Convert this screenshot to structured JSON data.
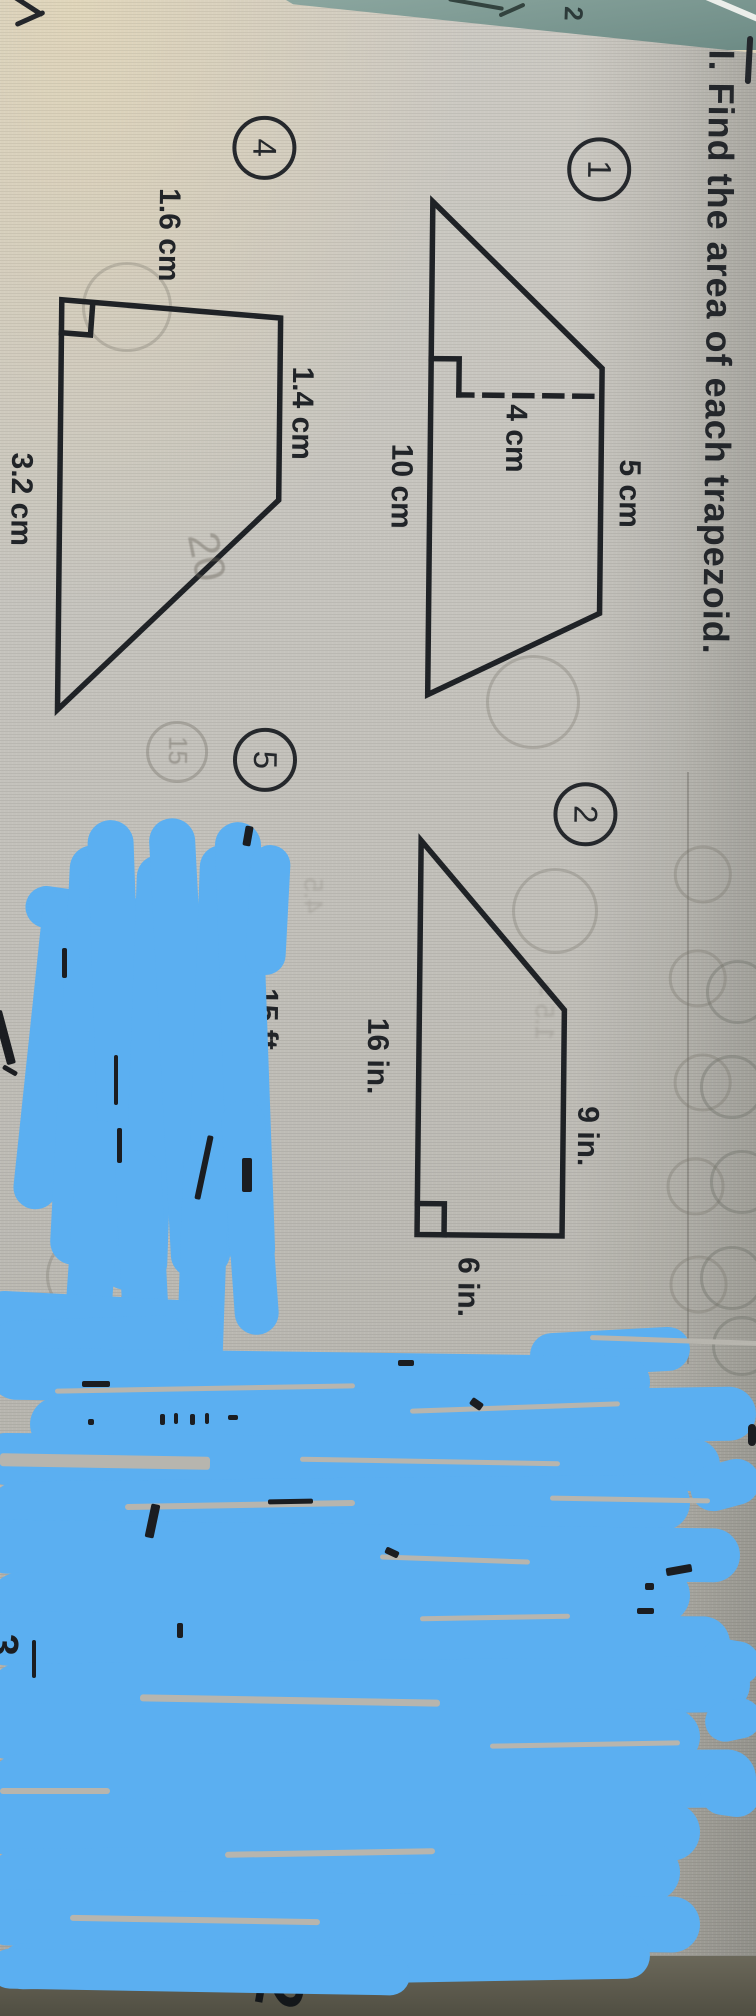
{
  "title": "I. Find the area of each trapezoid.",
  "problems": [
    {
      "number": "1",
      "dims": {
        "top": "5 cm",
        "height": "4 cm",
        "base": "10 cm"
      }
    },
    {
      "number": "2",
      "dims": {
        "top": "9 in.",
        "base": "16 in.",
        "side": "6 in."
      }
    },
    {
      "number": "4",
      "dims": {
        "left": "1.6 cm",
        "top": "1.4 cm",
        "base": "3.2 cm"
      }
    },
    {
      "number": "5",
      "dims": {
        "side": "15 ft"
      }
    }
  ],
  "handwriting": {
    "top_right_pencil": "2,",
    "teal_mark": "2",
    "left_edge_digit": "3",
    "desk_digit": "2",
    "ghost_answer": "20",
    "ghost_circled": "15"
  },
  "colors": {
    "marker_blue": "#5BAFF1",
    "teal_book": "#7E9B95",
    "ink": "#1F2226",
    "paper": "#C4C1BA"
  }
}
